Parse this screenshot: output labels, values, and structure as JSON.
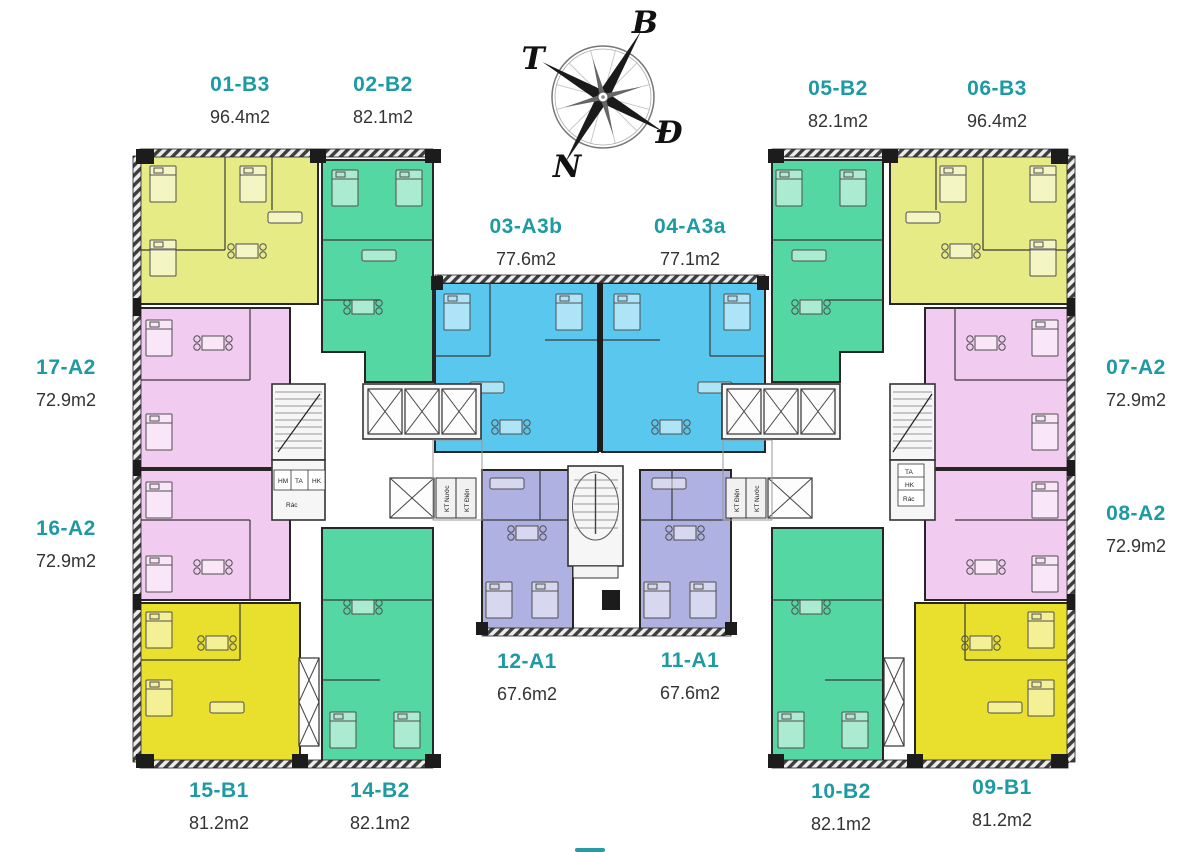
{
  "compass": {
    "b": "B",
    "d": "Đ",
    "n": "N",
    "t": "T"
  },
  "units": [
    {
      "code": "01-B3",
      "area": "96.4m2"
    },
    {
      "code": "02-B2",
      "area": "82.1m2"
    },
    {
      "code": "03-A3b",
      "area": "77.6m2"
    },
    {
      "code": "04-A3a",
      "area": "77.1m2"
    },
    {
      "code": "05-B2",
      "area": "82.1m2"
    },
    {
      "code": "06-B3",
      "area": "96.4m2"
    },
    {
      "code": "07-A2",
      "area": "72.9m2"
    },
    {
      "code": "08-A2",
      "area": "72.9m2"
    },
    {
      "code": "09-B1",
      "area": "81.2m2"
    },
    {
      "code": "10-B2",
      "area": "82.1m2"
    },
    {
      "code": "11-A1",
      "area": "67.6m2"
    },
    {
      "code": "12-A1",
      "area": "67.6m2"
    },
    {
      "code": "14-B2",
      "area": "82.1m2"
    },
    {
      "code": "15-B1",
      "area": "81.2m2"
    },
    {
      "code": "16-A2",
      "area": "72.9m2"
    },
    {
      "code": "17-A2",
      "area": "72.9m2"
    }
  ],
  "technical": {
    "kt_nuoc": "KT Nước",
    "kt_dien": "KT Điện",
    "ta": "TA",
    "hk": "HK",
    "hm": "HM",
    "rac": "Rác"
  },
  "colors": {
    "type_B3": "#e6eb86",
    "type_B2": "#54d7a2",
    "type_A3": "#5ac8ee",
    "type_A2": "#f2ccf0",
    "type_A1": "#aeb1e1",
    "type_B1": "#e8e02c",
    "label_teal": "#1d9aa3",
    "area_text": "#333333"
  }
}
